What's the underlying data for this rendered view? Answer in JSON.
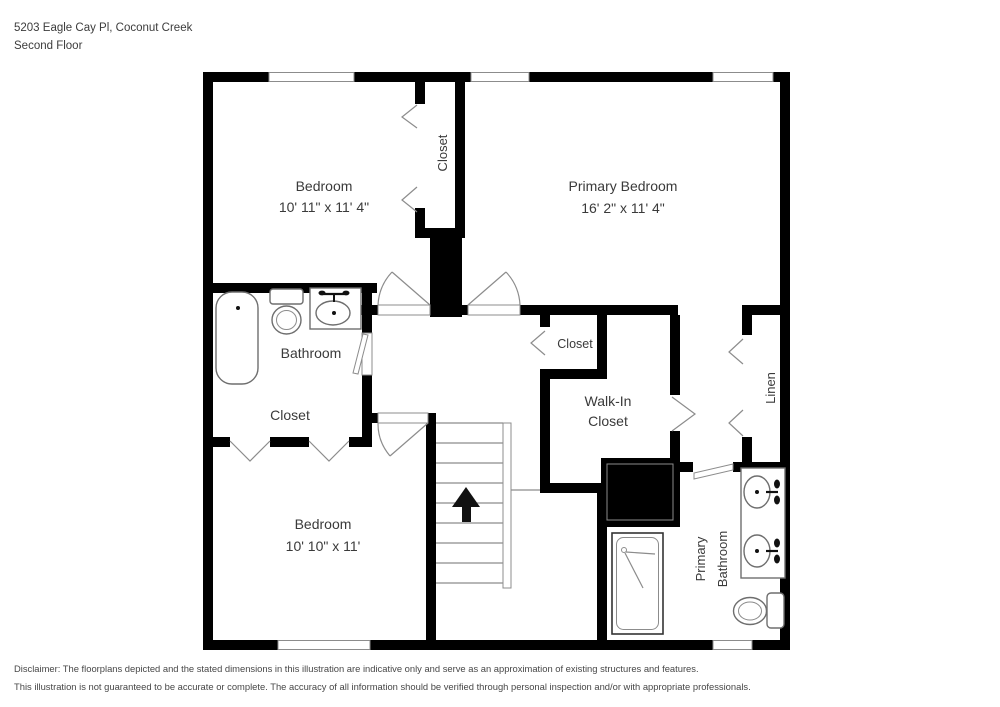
{
  "header": {
    "address": "5203 Eagle Cay Pl, Coconut Creek",
    "floor": "Second Floor"
  },
  "rooms": {
    "bedroom_top": {
      "name": "Bedroom",
      "dims": "10' 11\" x 11' 4\""
    },
    "closet_top": {
      "name": "Closet"
    },
    "primary_bedroom": {
      "name": "Primary Bedroom",
      "dims": "16' 2\" x 11' 4\""
    },
    "bathroom": {
      "name": "Bathroom"
    },
    "closet_left": {
      "name": "Closet"
    },
    "closet_mid": {
      "name": "Closet"
    },
    "walk_in_closet": {
      "line1": "Walk-In",
      "line2": "Closet"
    },
    "linen": {
      "name": "Linen"
    },
    "bedroom_bottom": {
      "name": "Bedroom",
      "dims": "10' 10\" x 11'"
    },
    "primary_bathroom": {
      "line1": "Primary",
      "line2": "Bathroom"
    }
  },
  "colors": {
    "wall": "#000000",
    "label": "#3a3a3a",
    "detail": "#8c8c8c"
  },
  "disclaimer": {
    "line1": "Disclaimer: The floorplans depicted and the stated dimensions in this illustration are indicative only and serve as an approximation of existing structures and features.",
    "line2": "This illustration is not guaranteed to be accurate or complete. The accuracy of all information should be verified through personal inspection and/or with appropriate professionals."
  }
}
